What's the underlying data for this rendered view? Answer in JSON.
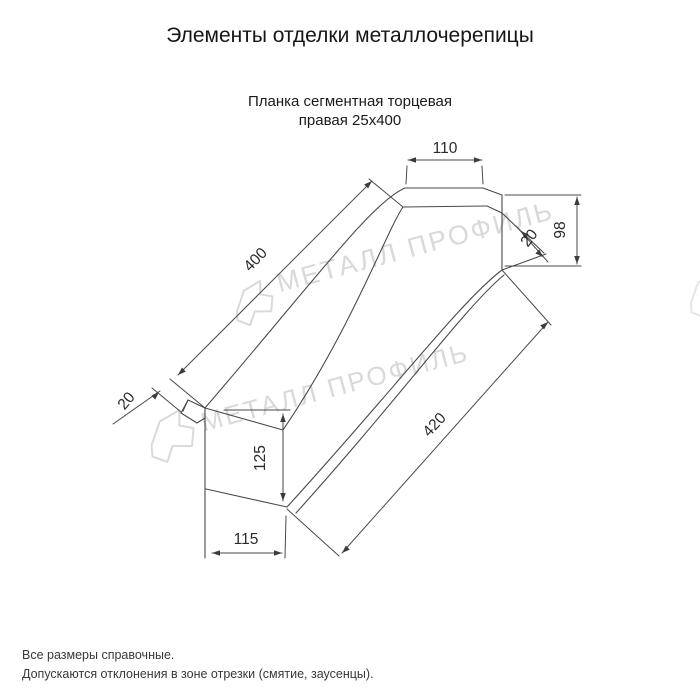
{
  "page": {
    "title": "Элементы отделки металлочерепицы"
  },
  "drawing": {
    "subtitle_line1": "Планка сегментная торцевая",
    "subtitle_line2": "правая 25х400",
    "dimensions": {
      "top_width": "110",
      "right_height": "98",
      "right_hem": "20",
      "length_top": "400",
      "length_bottom": "420",
      "left_hem": "20",
      "left_height": "125",
      "bottom_width": "115"
    }
  },
  "watermark": {
    "text": "МЕТАЛЛ ПРОФИЛЬ"
  },
  "footer": {
    "note1": "Все размеры справочные.",
    "note2": "Допускаются отклонения в зоне отрезки (смятие, заусенцы)."
  },
  "colors": {
    "line": "#4a4a4a",
    "text": "#2a2a2a",
    "watermark": "#d9d9d9"
  }
}
